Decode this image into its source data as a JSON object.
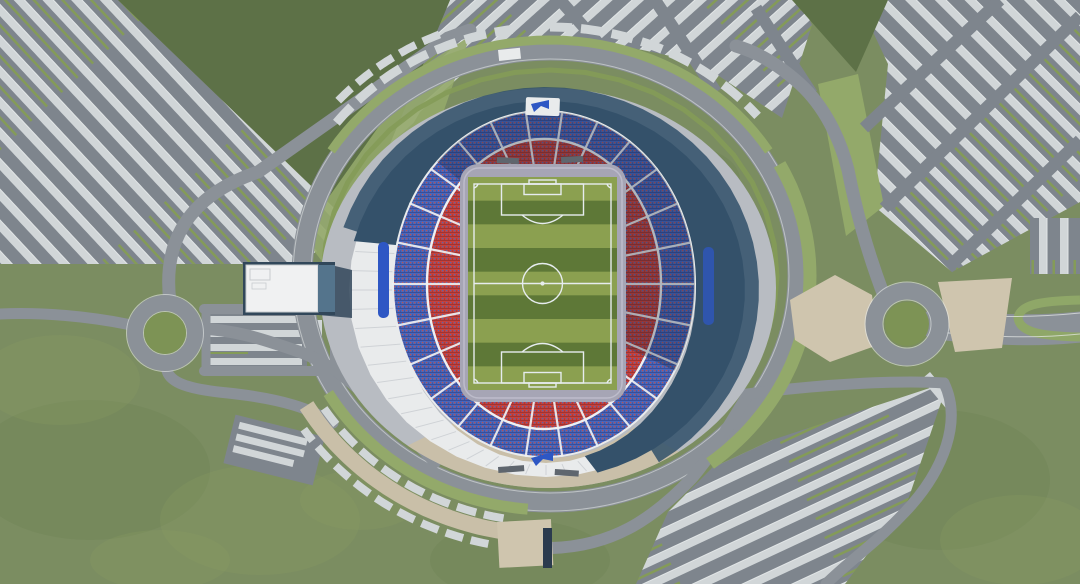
{
  "scene": {
    "width": 1080,
    "height": 584,
    "stadium": {
      "pitch_stripe_count": 9,
      "radial_aisle_count": 26,
      "roof_seam_count": 20,
      "upper_tier_color_name": "blue",
      "lower_tier_color_name": "red"
    },
    "roundabouts": 2,
    "parking_lots": 6
  },
  "palette": {
    "grassBase": "#7b8d61",
    "grassDark": "#5d7147",
    "grassBlobLight": "#8da166",
    "grassBlobDark": "#66794e",
    "lime": "#93a96a",
    "verge": "#849b58",
    "roadGray": "#8b9198",
    "roadLine": "#e8ebea",
    "aisleGray": "#7e858d",
    "carStrip": "#d1d6d8",
    "carStripHi": "#e2e6e7",
    "greenSliver": "#849b58",
    "roofWhite": "#e9ebec",
    "roofSeam": "#c9cdd1",
    "shadowDark": "#34516a",
    "shadowCast": "#30506a",
    "seatRed": "#c5423f",
    "seatRedDark": "#9c3230",
    "seatBlue": "#4b66ba",
    "seatBlueDark": "#354c97",
    "seatFleckRed": "#bf4f4a",
    "seatFleckBlue": "#4f69b4",
    "tierWhite": "#eef0f2",
    "apronGray": "#b8bcc2",
    "apronRect": "#a6a5b5",
    "apronEdge": "#bdbccb",
    "pitchLight": "#8ba050",
    "pitchDark": "#5e7837",
    "pitchLine": "#e6ecee",
    "beige": "#c9bfa8",
    "plazaBeige": "#cfc5ae",
    "buildingWhite": "#f0f1f2",
    "buildingDark": "#31475a",
    "buildingTrim": "#c8cccf",
    "glyphBlue": "#2e57c4",
    "rndGreen": "#7d9355",
    "medianGreen": "#8fa768",
    "darkSlot": "#2b3b4e",
    "dugout": "#5f666e"
  }
}
